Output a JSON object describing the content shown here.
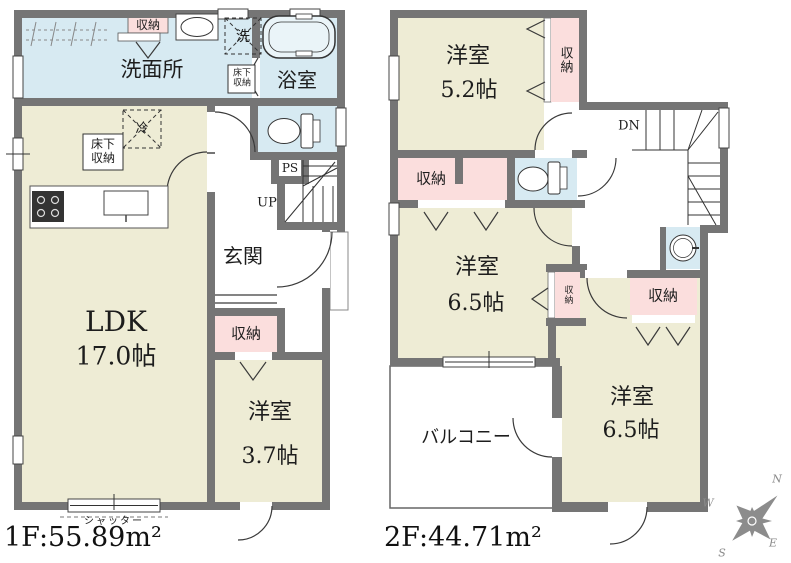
{
  "colors": {
    "wall": "#757575",
    "room_cream": "#eeecd5",
    "wet_blue": "#d7eaf2",
    "closet_pink": "#fbdedd",
    "line": "#3a3a3a",
    "compass_gray": "#8c8c8c"
  },
  "floor1": {
    "area_label": "1F:55.89m²",
    "washroom_label": "洗面所",
    "washroom_closet_label": "収納",
    "laundry_label": "洗",
    "bathroom_label": "浴室",
    "underfloor_storage_line1": "床下",
    "underfloor_storage_line2": "収納",
    "fridge_label": "冷",
    "ldk_name": "LDK",
    "ldk_size": "17.0帖",
    "pipe_space_label": "PS",
    "stairs_label": "UP",
    "entrance_label": "玄関",
    "hall_closet_label": "収納",
    "western_room_name": "洋室",
    "western_room_size": "3.7帖",
    "shutter_label": "シャッター"
  },
  "floor2": {
    "area_label": "2F:44.71m²",
    "bedroom_52_name": "洋室",
    "bedroom_52_size": "5.2帖",
    "bedroom_52_closet_label": "収納",
    "stairs_label": "DN",
    "hall_closet_label": "収納",
    "bedroom_65l_name": "洋室",
    "bedroom_65l_size": "6.5帖",
    "bedroom_65l_closet_label": "収納",
    "bedroom_65r_closet_label": "収納",
    "bedroom_65r_name": "洋室",
    "bedroom_65r_size": "6.5帖",
    "balcony_label": "バルコニー"
  },
  "compass": {
    "north": "N",
    "west": "W",
    "east": "E",
    "south": "S"
  }
}
